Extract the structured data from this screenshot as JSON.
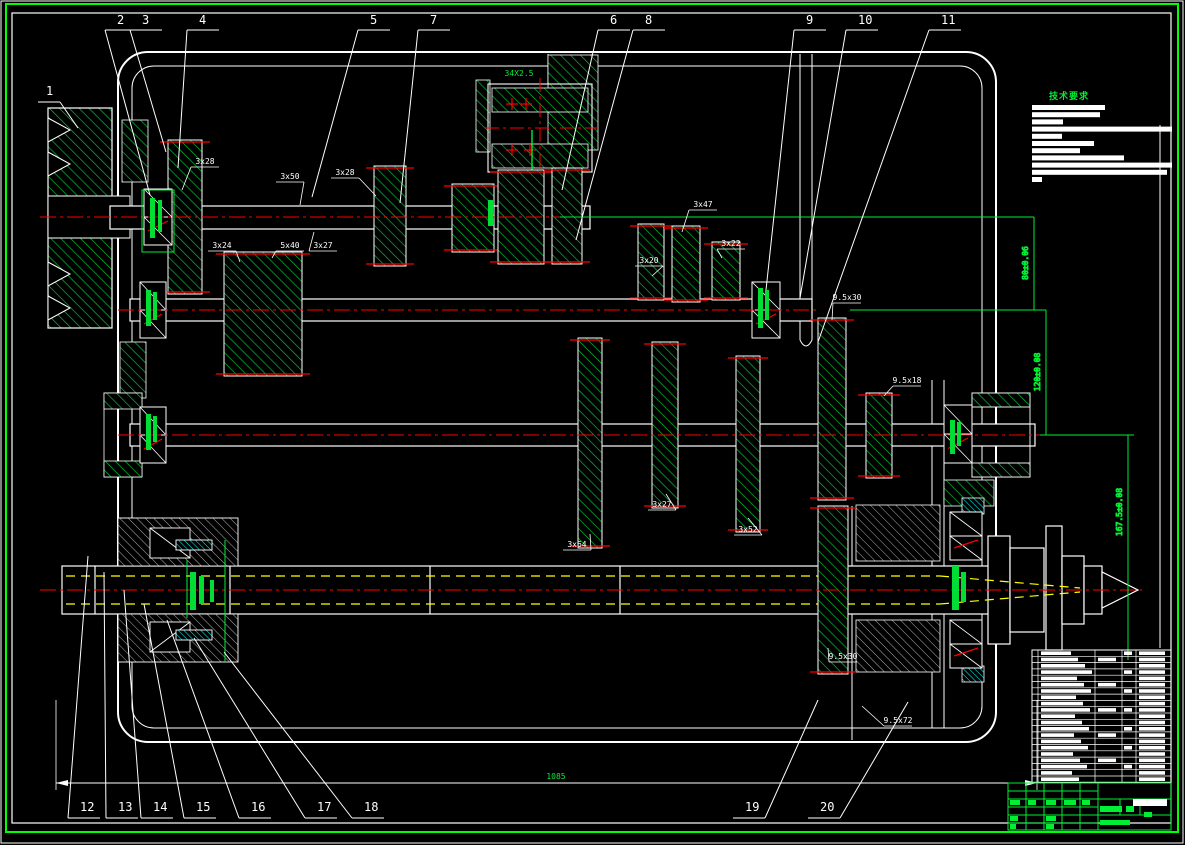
{
  "drawing": {
    "type": "mechanical-assembly-section",
    "subject": "gearbox-spindle-assembly"
  },
  "colors": {
    "background": "#000000",
    "line_white": "#ffffff",
    "frame_green": "#00ff00",
    "hatch_green": "#00cc33",
    "centerline_red": "#ff0000",
    "aux_yellow": "#ffff00",
    "seal_cyan": "#00ffff"
  },
  "callouts": {
    "top": [
      {
        "label": "2",
        "x": 117,
        "ax": 150,
        "ay": 195
      },
      {
        "label": "3",
        "x": 142,
        "ax": 166,
        "ay": 152
      },
      {
        "label": "4",
        "x": 199,
        "ax": 178,
        "ay": 168
      },
      {
        "label": "5",
        "x": 370,
        "ax": 312,
        "ay": 197
      },
      {
        "label": "7",
        "x": 430,
        "ax": 400,
        "ay": 203
      },
      {
        "label": "6",
        "x": 610,
        "ax": 562,
        "ay": 190
      },
      {
        "label": "8",
        "x": 645,
        "ax": 576,
        "ay": 240
      },
      {
        "label": "9",
        "x": 806,
        "ax": 766,
        "ay": 290
      },
      {
        "label": "10",
        "x": 858,
        "ax": 800,
        "ay": 298
      },
      {
        "label": "11",
        "x": 941,
        "ax": 818,
        "ay": 342
      }
    ],
    "bottom": [
      {
        "label": "12",
        "x": 80,
        "ax": 88,
        "ay": 556
      },
      {
        "label": "13",
        "x": 118,
        "ax": 104,
        "ay": 572
      },
      {
        "label": "14",
        "x": 153,
        "ax": 124,
        "ay": 590
      },
      {
        "label": "15",
        "x": 196,
        "ax": 144,
        "ay": 604
      },
      {
        "label": "16",
        "x": 251,
        "ax": 167,
        "ay": 620
      },
      {
        "label": "17",
        "x": 317,
        "ax": 194,
        "ay": 638
      },
      {
        "label": "18",
        "x": 364,
        "ax": 224,
        "ay": 652
      },
      {
        "label": "19",
        "x": 745,
        "dir": "r",
        "ax": 818,
        "ay": 700
      },
      {
        "label": "20",
        "x": 820,
        "dir": "r",
        "ax": 908,
        "ay": 702
      }
    ],
    "side": [
      {
        "label": "1",
        "x": 46,
        "y": 95,
        "ax": 78,
        "ay": 128
      }
    ]
  },
  "dimension_labels": [
    {
      "text": "3x28",
      "x": 205,
      "y": 164,
      "ax": 182,
      "ay": 190
    },
    {
      "text": "3x50",
      "x": 290,
      "y": 179,
      "ax": 300,
      "ay": 205
    },
    {
      "text": "3x28",
      "x": 345,
      "y": 175,
      "ax": 376,
      "ay": 196
    },
    {
      "text": "3x24",
      "x": 222,
      "y": 248,
      "ax": 240,
      "ay": 262
    },
    {
      "text": "5x40",
      "x": 290,
      "y": 248,
      "ax": 272,
      "ay": 258
    },
    {
      "text": "3x27",
      "x": 323,
      "y": 248,
      "ax": 314,
      "ay": 232
    },
    {
      "text": "3x47",
      "x": 703,
      "y": 207,
      "ax": 682,
      "ay": 232
    },
    {
      "text": "3x22",
      "x": 731,
      "y": 246,
      "ax": 722,
      "ay": 258
    },
    {
      "text": "3x20",
      "x": 649,
      "y": 263,
      "ax": 652,
      "ay": 276
    },
    {
      "text": "3x64",
      "x": 577,
      "y": 547,
      "ax": 590,
      "ay": 534
    },
    {
      "text": "3x27",
      "x": 662,
      "y": 507,
      "ax": 666,
      "ay": 494
    },
    {
      "text": "3x52",
      "x": 748,
      "y": 532,
      "ax": 748,
      "ay": 518
    },
    {
      "text": "9.5x30",
      "x": 847,
      "y": 300,
      "ax": 832,
      "ay": 320
    },
    {
      "text": "9.5x18",
      "x": 907,
      "y": 383,
      "ax": 884,
      "ay": 396
    },
    {
      "text": "9.5x30",
      "x": 843,
      "y": 659,
      "ax": 828,
      "ay": 648
    },
    {
      "text": "9.5x72",
      "x": 898,
      "y": 723,
      "ax": 862,
      "ay": 706
    }
  ],
  "axis_dimensions": [
    {
      "text": "80±0.06"
    },
    {
      "text": "120±0.08"
    },
    {
      "text": "167.5±0.08"
    }
  ],
  "overall_dimension": {
    "text": "1085"
  },
  "assembly_labels": {
    "top": "34X2.5",
    "bottom": "34X2.5"
  },
  "notes": {
    "title": "技术要求",
    "bars": [
      73,
      68,
      31,
      140,
      30,
      62,
      48,
      92,
      140,
      135,
      10
    ]
  },
  "bom": {
    "rows": 21
  },
  "title_block": {
    "filled_cells_color": "#00ee33"
  }
}
